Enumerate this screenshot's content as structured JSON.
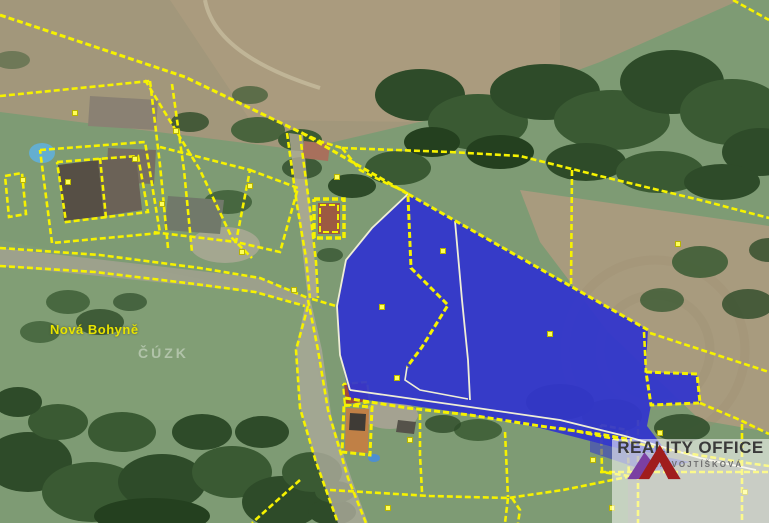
{
  "map": {
    "place_label": "Nová Bohyně",
    "watermark": "ČÚZK",
    "colors": {
      "parcel_line": "#f6f200",
      "highlight_fill": "#3235cd",
      "inner_boundary": "#efeed6",
      "marker": "#ffff59",
      "label": "#e8e400"
    }
  },
  "logo": {
    "title": "REALITY OFFICE",
    "subtitle": "JANA VOJTÍŠKOVÁ",
    "mark_left_color": "#7b3fa2",
    "mark_right_color": "#a01d1d"
  }
}
